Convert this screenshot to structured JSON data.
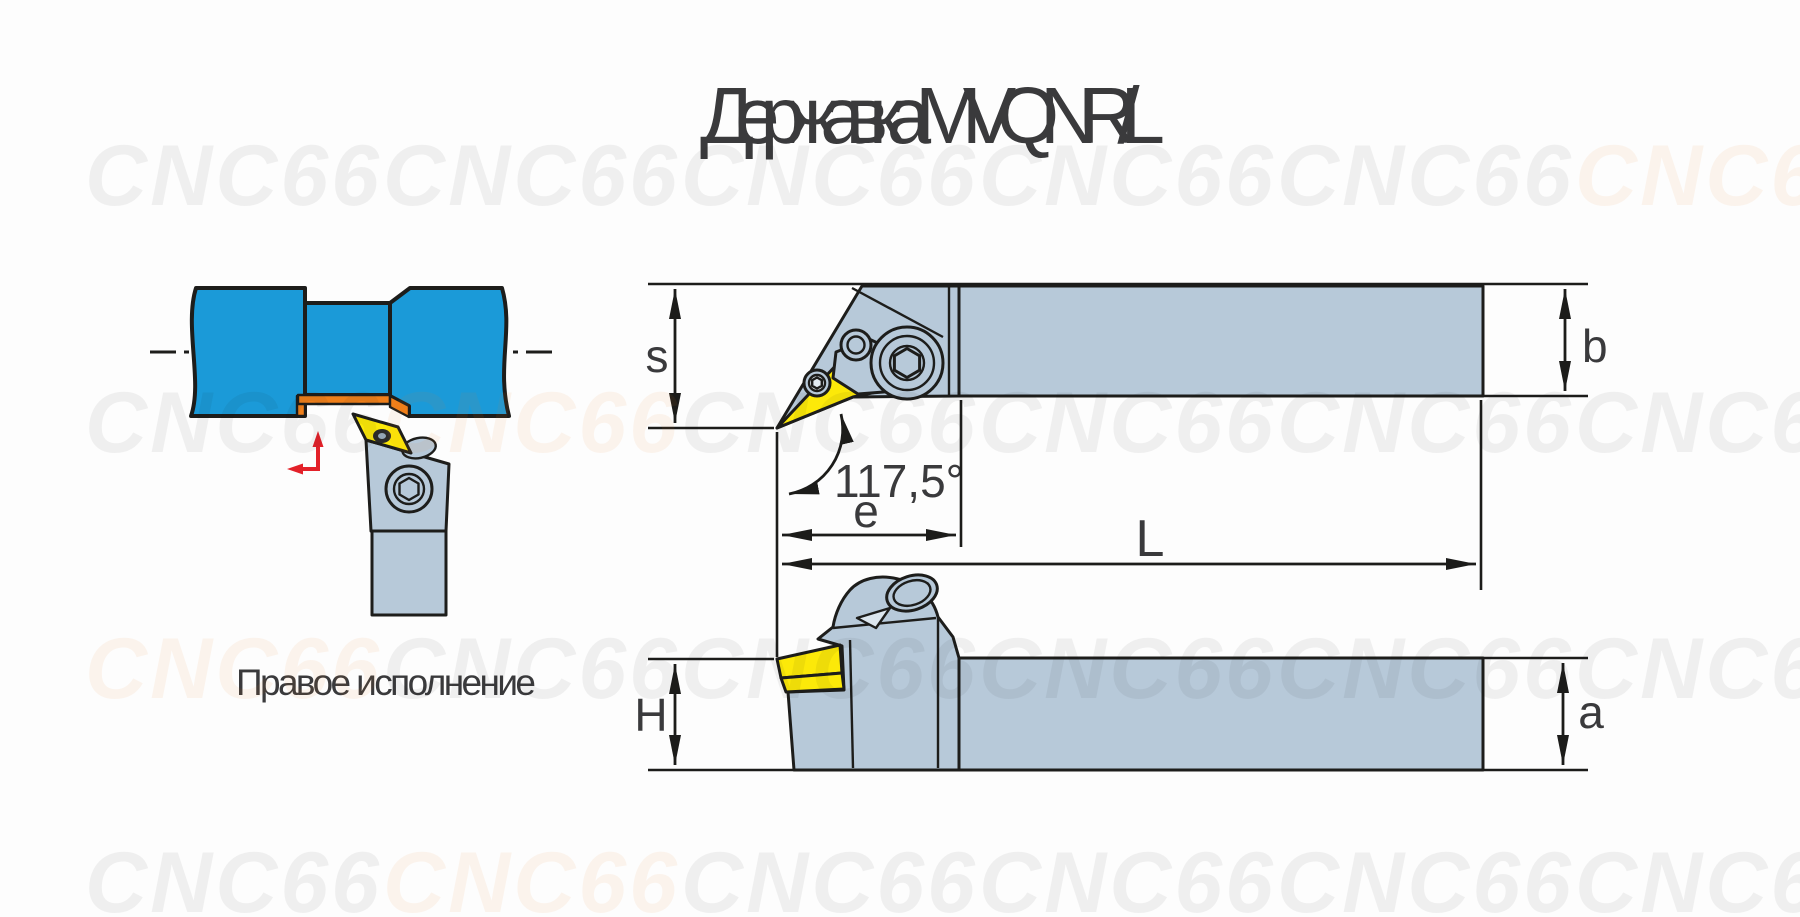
{
  "title": "Державка MVQNR/L",
  "watermark": {
    "text": "CNC66"
  },
  "illustration": {
    "caption": "Правое исполнение"
  },
  "dimensions": {
    "s": "s",
    "b": "b",
    "e": "e",
    "L": "L",
    "H": "H",
    "a": "a",
    "corner_angle": "117,5°"
  },
  "colors": {
    "workpiece_blue": "#1b9ad8",
    "machined_orange": "#ef7f1a",
    "holder_body": "#b7c9d9",
    "insert_yellow": "#fce909",
    "insert_hole_light": "#e3ebf2",
    "outline_dark": "#1d1d1b",
    "feed_arrow_red": "#e32129",
    "text_dark": "#3a3a3c"
  }
}
